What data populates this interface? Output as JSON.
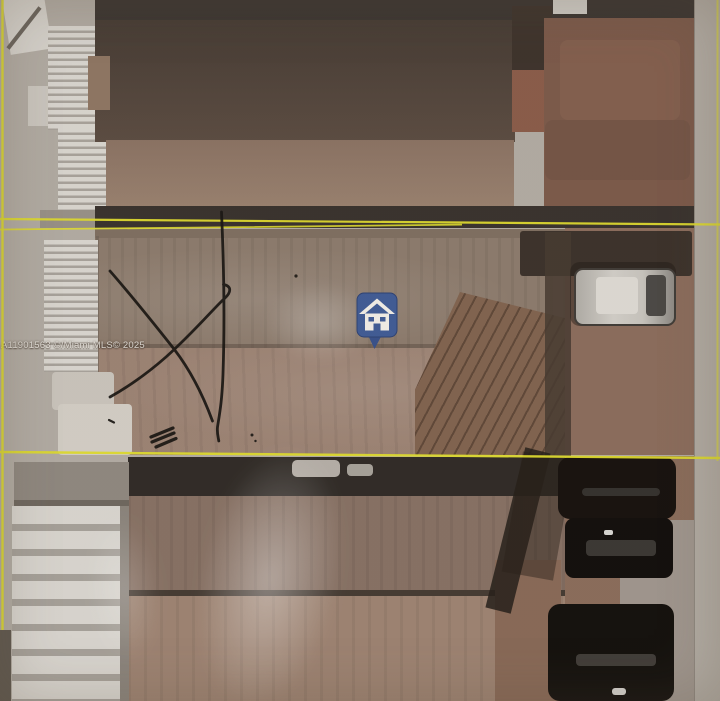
{
  "title": "Aerial MLS property photo with parcel boundary overlay",
  "watermark": {
    "text": "A11901563 ©/Miami MLS© 2025"
  },
  "marker": {
    "icon": "home-marker-icon",
    "shape": "rounded-square map pin with white house glyph and downward tail",
    "pin_color": "#3f5b96",
    "glyph_color": "#f2efe8"
  },
  "boundary_lines": {
    "color": "#dedb2e",
    "description": "yellow parcel boundary lines",
    "horizontal_lines_y": [
      222,
      455
    ],
    "left_vertical_x": 3,
    "right_vertical_x": 718
  },
  "hand_annotations": {
    "ink_color": "#181512",
    "items": [
      "large X mark over left side of subject roof",
      "long vertical stroke through boundary line",
      "small triple hatch mark",
      "tiny ink dots"
    ]
  },
  "scene": {
    "subject": "single-family home hip roof between two yellow boundary lines",
    "vehicles": [
      "silver car in right driveway (middle band)",
      "black car upper (bottom right)",
      "black car middle (bottom right)",
      "black car lower (bottom right)"
    ],
    "structures": [
      "corrugated white awning strips (top left)",
      "corrugated white carport (bottom left)",
      "dark shingle neighbor roof (top)",
      "red-brown neighbor roof (top right)",
      "brown neighbor roof (bottom)"
    ]
  }
}
